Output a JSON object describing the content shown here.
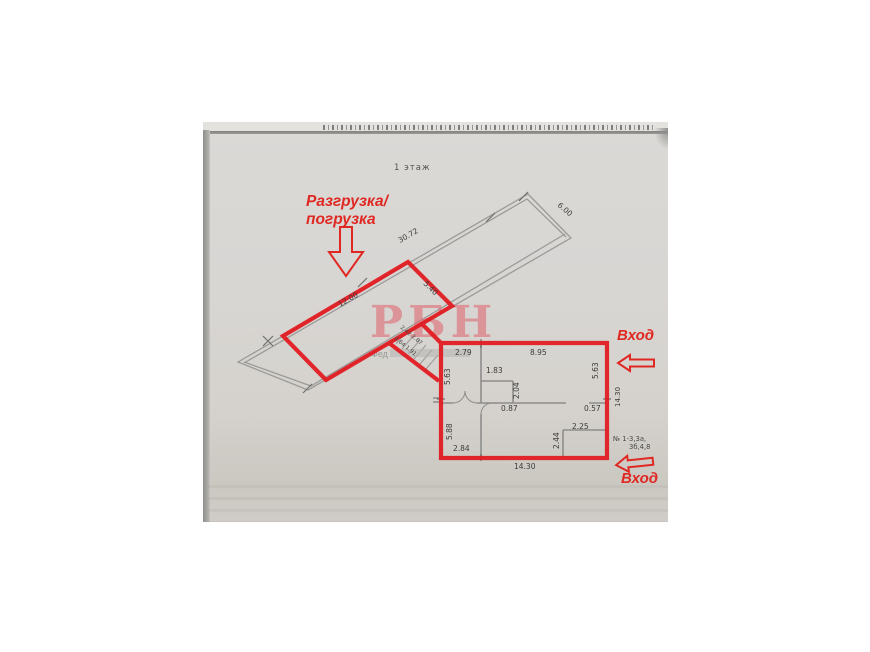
{
  "document": {
    "floor_label": "1 этаж"
  },
  "annotations": {
    "unloading_line1": "Разгрузка/",
    "unloading_line2": "погрузка",
    "entrance_top": "Вход",
    "entrance_bottom": "Вход",
    "unit_numbers_line1": "№ 1-3,3а,",
    "unit_numbers_line2": "3б,4,8"
  },
  "watermark": {
    "letters": "РБН",
    "subtext": "Фед"
  },
  "dimensions": {
    "hall": {
      "length": "30.72",
      "end_width": "6.00",
      "red_length": "12.00",
      "red_width": "5.40"
    },
    "stairs": [
      "2.42",
      "2.87",
      "4.64",
      "1.91"
    ],
    "block": {
      "top_left": "2.79",
      "top_right": "8.95",
      "inner_room": "1.83",
      "left_upper": "5.63",
      "right_upper": "5.63",
      "inner_height": "2.04",
      "mid_left": "0.87",
      "mid_right": "0.57",
      "left_lower": "5.88",
      "closet_width": "2.25",
      "closet_height": "2.44",
      "room_bottom": "2.84",
      "bottom": "14.30",
      "right_side": "14.30"
    }
  },
  "colors": {
    "highlight_red": "#e2191f",
    "annotation_red": "#e02823",
    "paper": "#d7d5d2",
    "plan_line": "#9b9b99",
    "watermark_pink": "#e0626b"
  }
}
